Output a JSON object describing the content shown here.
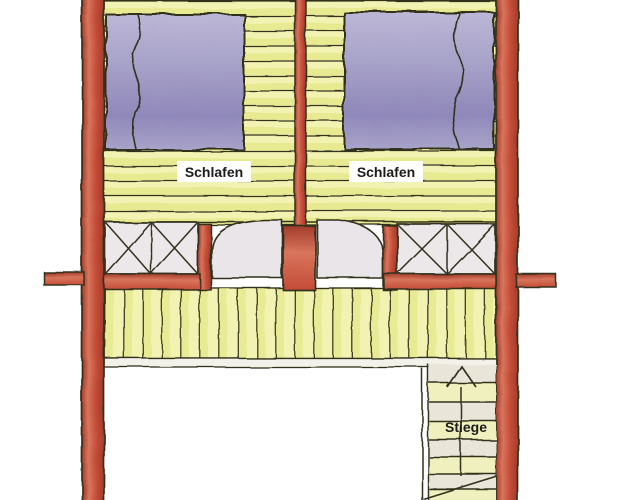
{
  "labels": {
    "bedroom_left": "Schlafen",
    "bedroom_right": "Schlafen",
    "stair": "Stiege"
  },
  "colors": {
    "paper": "#ffffff",
    "ink": "#33311f",
    "wall-red": "#c44c38",
    "wall-red-light": "#d8755c",
    "wall-red-dark": "#a23b2a",
    "floor-yellow": "#f2f3b2",
    "floor-stripe": "#e3e784",
    "bed-purple": "#a8a3c9",
    "bed-purple-light": "#bcb7d6",
    "bed-purple-dark": "#8f88ba",
    "panel-grey": "#ece8ea",
    "door-grey": "#e9e5e8",
    "tread-yellow": "#eff0bd",
    "tread-grey": "#e9e6d9",
    "strip-grey": "#f3f2ea",
    "label-bg": "#ffffff",
    "label-text": "#1c1c1a"
  }
}
